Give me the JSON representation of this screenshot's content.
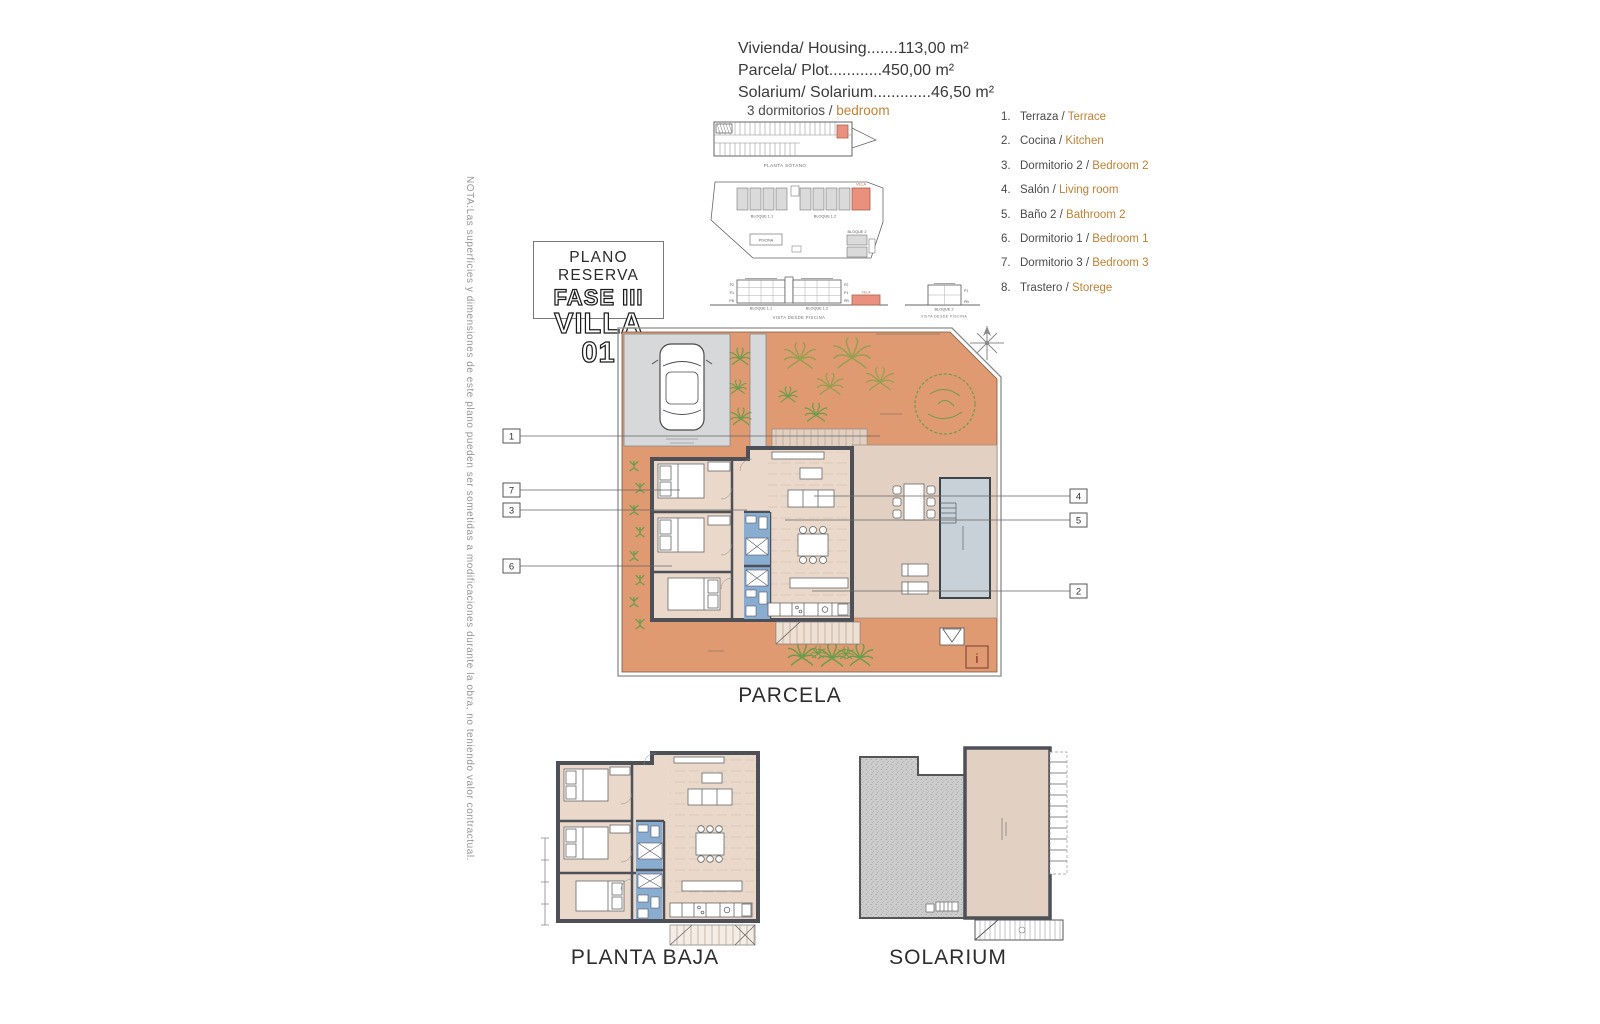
{
  "note_vertical": "NOTA:Las superficies y dimensiones de este plano pueden ser sometidas a modificaciones durante la obra, no teniendo valor contractual.",
  "title_box": {
    "line1": "PLANO RESERVA",
    "line2": "FASE III",
    "line3": "VILLA 01"
  },
  "areas": {
    "lines": [
      "Vivienda/ Housing.......113,00 m²",
      "Parcela/ Plot............450,00 m²",
      "Solarium/ Solarium.............46,50 m²"
    ]
  },
  "bedrooms": {
    "es": "3 dormitorios / ",
    "en": "bedroom"
  },
  "legend": {
    "items": [
      {
        "num": "1.",
        "es": "Terraza / ",
        "en": "Terrace"
      },
      {
        "num": "2.",
        "es": "Cocina / ",
        "en": "Kitchen"
      },
      {
        "num": "3.",
        "es": "Dormitorio 2 / ",
        "en": "Bedroom 2"
      },
      {
        "num": "4.",
        "es": "Salón / ",
        "en": "Living room"
      },
      {
        "num": "5.",
        "es": "Baño 2 / ",
        "en": "Bathroom 2"
      },
      {
        "num": "6.",
        "es": "Dormitorio 1 / ",
        "en": "Bedroom 1"
      },
      {
        "num": "7.",
        "es": "Dormitorio 3 / ",
        "en": "Bedroom 3"
      },
      {
        "num": "8.",
        "es": "Trastero / ",
        "en": "Storege"
      }
    ]
  },
  "callouts": {
    "left": [
      "1",
      "7",
      "3",
      "6"
    ],
    "right": [
      "4",
      "5",
      "2"
    ]
  },
  "plans": {
    "parcela": "PARCELA",
    "planta_baja": "PLANTA BAJA",
    "solarium": "SOLARIUM"
  },
  "site": {
    "strip_caption": "PLANTA SÓTANO",
    "bloque11": "BLOQUE 1.1",
    "bloque12": "BLOQUE 1.2",
    "bloque2": "BLOQUE 2",
    "villa": "VILLA",
    "piscina": "PISCINA",
    "vista_caption": "VISTA DESDE PISCINA",
    "info_marker": "i",
    "floors": {
      "p2": "P2",
      "p1": "P1",
      "pb": "PB"
    }
  },
  "colors": {
    "plot": "#df9a71",
    "wall": "#4d5157",
    "bath": "#89add0",
    "pool": "#c8d1d8",
    "interior": "#ead9ca",
    "terrace": "#e2d1c2",
    "drive": "#d6d8da",
    "green": "#6b9d4a",
    "olive": "#93a04e",
    "salmon": "#e9917e",
    "accent": "#bf8136"
  }
}
